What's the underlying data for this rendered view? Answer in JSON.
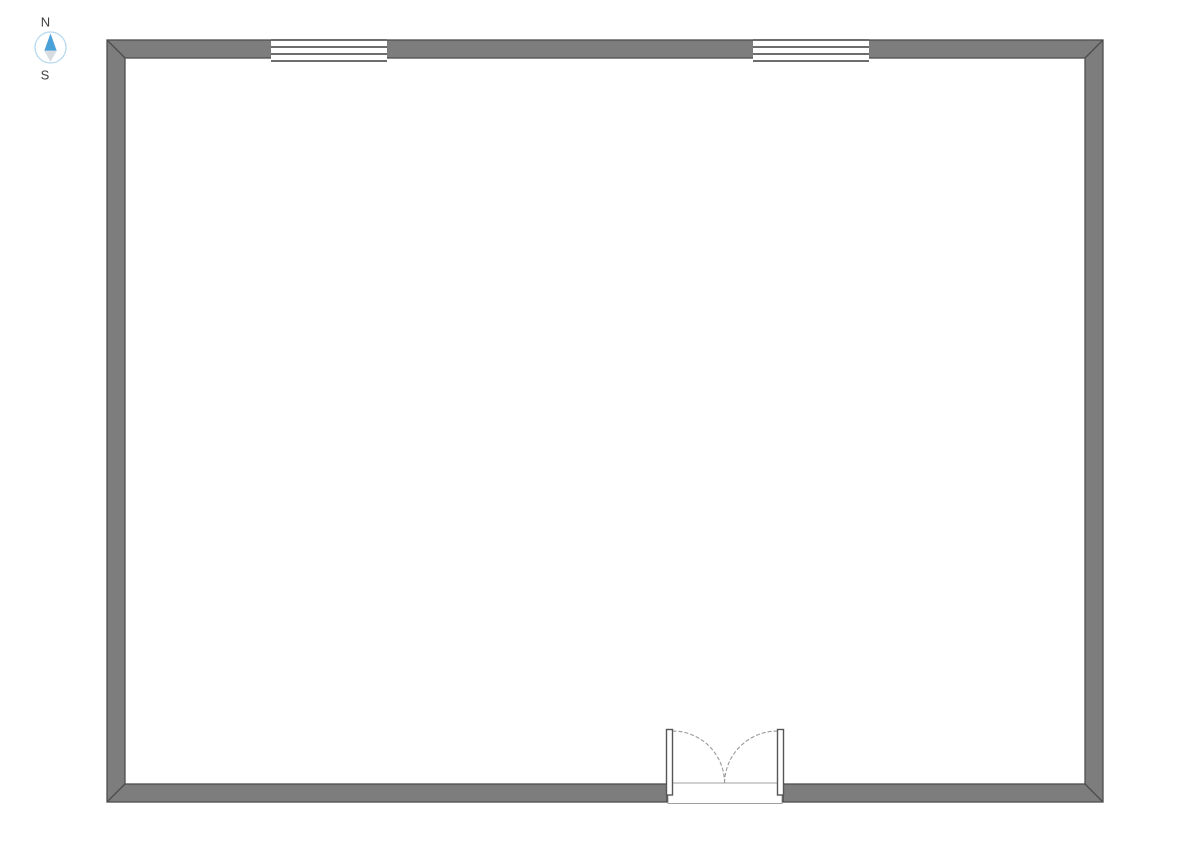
{
  "compass": {
    "north_label": "N",
    "south_label": "S",
    "label_color": "#3f3f3f",
    "ring_color": "#b7d9ef",
    "needle_north_color": "#4aa0d8",
    "needle_south_color": "#d8dde1"
  },
  "floor_plan": {
    "background_color": "#ffffff",
    "wall_fill_color": "#7d7d7d",
    "wall_edge_color": "#4d4d4d",
    "window_fill_color": "#ffffff",
    "window_line_color": "#6d6d6d",
    "door_leaf_fill_color": "#ffffff",
    "door_leaf_edge_color": "#565656",
    "door_arc_color": "#9b9b9b",
    "door_sill_fill_color": "#ffffff",
    "door_sill_edge_color": "#a0a0a0",
    "windows": [
      {
        "name": "top-wall-window-left"
      },
      {
        "name": "top-wall-window-right"
      }
    ],
    "door": {
      "name": "bottom-wall-double-door",
      "type": "double-swing-inward"
    }
  }
}
